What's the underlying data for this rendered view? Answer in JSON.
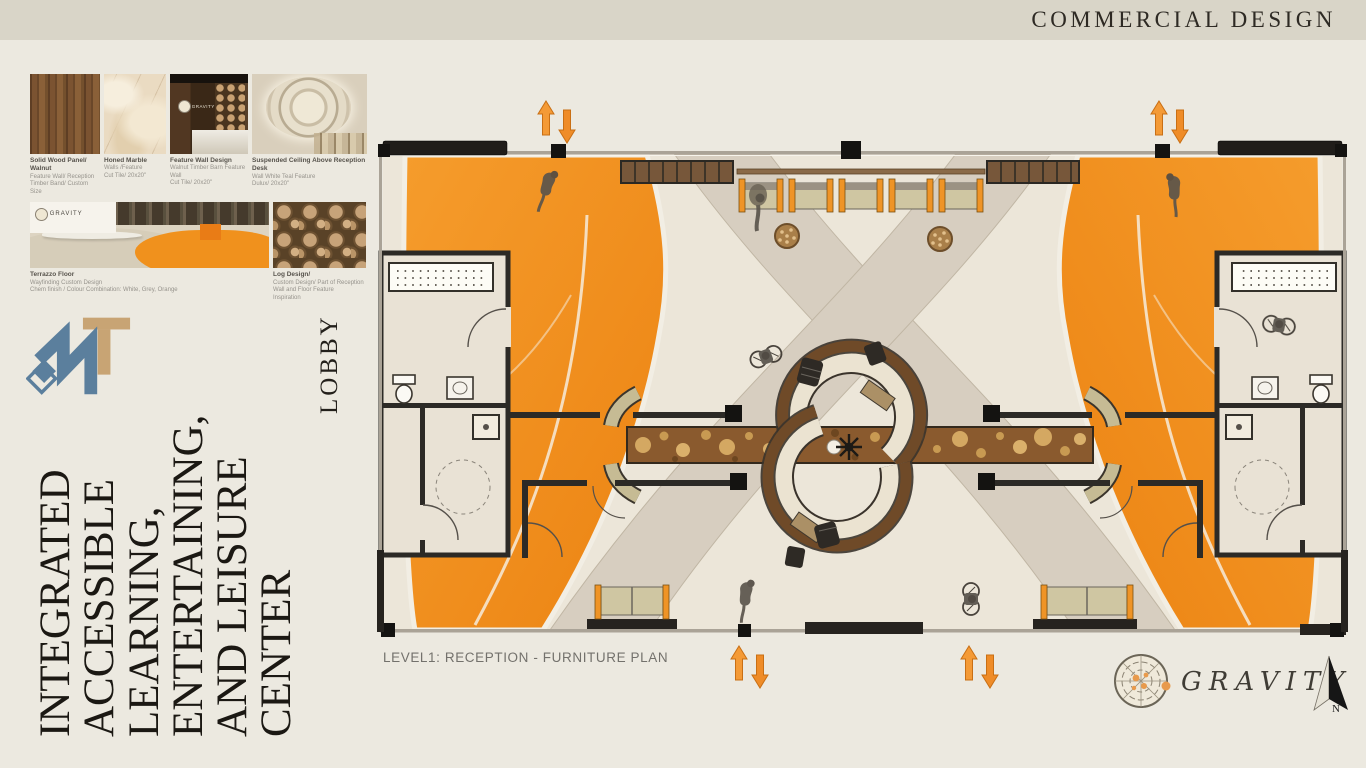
{
  "header": {
    "title": "COMMERCIAL DESIGN"
  },
  "materials": {
    "row1": [
      {
        "name": "Solid Wood Panel/ Walnut",
        "d1": "Feature Wall/ Reception",
        "d2": "Timber Band/ Custom Size"
      },
      {
        "name": "Honed Marble",
        "d1": "Walls /Feature",
        "d2": "Cut Tile/ 20x20\""
      },
      {
        "name": "Feature Wall Design",
        "d1": "Walnut Timber Barn Feature Wall",
        "d2": "Cut Tile/ 20x20\""
      },
      {
        "name": "Suspended Ceiling Above Reception Desk",
        "d1": "Wall White Teal Feature",
        "d2": "Dulux/ 20x20\""
      }
    ],
    "row2": [
      {
        "name": "Terrazzo Floor",
        "d1": "Wayfinding Custom Design",
        "d2": "Chem finish / Colour Combination: White, Grey, Orange"
      },
      {
        "name": "Log Design/",
        "d1": "Custom Design/ Part of Reception Wall and Floor Feature",
        "d2": "Inspiration"
      }
    ],
    "wall_logo": "GRAVITY"
  },
  "branding": {
    "logo_letters": "MT"
  },
  "project": {
    "room_label": "LOBBY",
    "title_lines": [
      "INTEGRATED",
      "ACCESSIBLE",
      "LEARNING,",
      "ENTERTAINING,",
      "AND LEISURE",
      "CENTER"
    ]
  },
  "plan": {
    "caption": "LEVEL1: RECEPTION - FURNITURE PLAN"
  },
  "footer": {
    "brand": "GRAVITY",
    "north_label": "N"
  },
  "colors": {
    "accent_orange": "#f0931f",
    "wood_brown": "#8a5a2e",
    "steel_blue": "#5b7f9d",
    "tan": "#c8a474",
    "wall_dark": "#262522",
    "page_bg": "#ece9e0",
    "band_bg": "#d9d5c8"
  }
}
